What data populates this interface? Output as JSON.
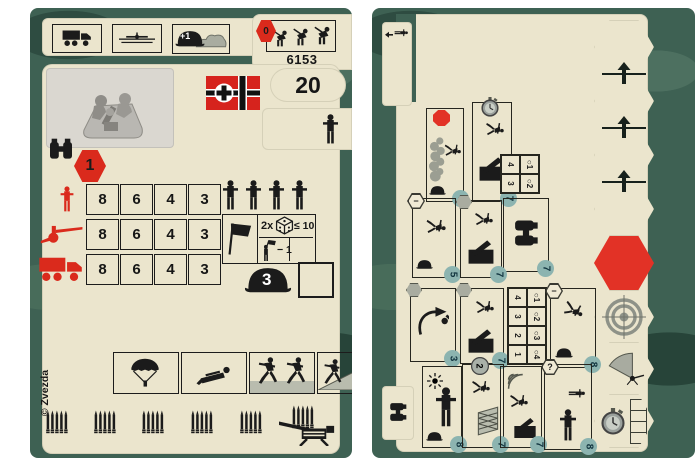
{
  "left_card": {
    "product_code": "6153",
    "points": "20",
    "cover_bonus": "+1",
    "entrench_badge": "0",
    "recon_badge": "1",
    "top_icons": [
      "truck-transport",
      "air-transport",
      "cover-bonus-terrain",
      "entrench-order"
    ],
    "flag": "german-war-flag",
    "photo": "mortar-crew-miniature",
    "stats": {
      "rows": [
        {
          "target": "infantry",
          "values": [
            "8",
            "6",
            "4",
            "3"
          ]
        },
        {
          "target": "artillery",
          "values": [
            "8",
            "6",
            "4",
            "3"
          ]
        },
        {
          "target": "vehicle",
          "values": [
            "8",
            "6",
            "4",
            "3"
          ]
        }
      ]
    },
    "squad_figures": 4,
    "morale": {
      "multiplier": "2x",
      "threshold": "≤ 10",
      "penalty": "− 1"
    },
    "helmet_value": "3",
    "ability_icons": [
      "parachute-drop",
      "crawl",
      "assault-charge",
      "vault-obstacle"
    ],
    "ammo_clips": 6,
    "copyright": "© Zvezda"
  },
  "right_card": {
    "small_table": {
      "headers": [
        "○1",
        "○2"
      ],
      "values": [
        "4",
        "3"
      ]
    },
    "range_table": {
      "headers": [
        "○1",
        "○2",
        "○3",
        "○4"
      ],
      "values": [
        "4",
        "3",
        "2",
        "1"
      ]
    },
    "panels": [
      {
        "name": "smoke-screen",
        "badge": "stop-octagon",
        "cost": "3"
      },
      {
        "name": "mortar-fire",
        "badge": "stopwatch",
        "cost": "7"
      },
      {
        "name": "spotting",
        "badge": "",
        "cost": "7"
      },
      {
        "name": "run",
        "badge": "minus-hex",
        "cost": "5"
      },
      {
        "name": "set-up-mortar",
        "badge": "gray-hex",
        "cost": "7"
      },
      {
        "name": "grenade-throw",
        "badge": "gray-hex",
        "cost": "3"
      },
      {
        "name": "take-cover",
        "badge": "gray-hex",
        "cost": "7"
      },
      {
        "name": "bail-out",
        "badge": "minus-hex",
        "cost": "8"
      },
      {
        "name": "signal-flare",
        "badge": "",
        "cost": "8"
      },
      {
        "name": "climb-obstacle",
        "badge": "stopwatch-2",
        "cost": "7"
      },
      {
        "name": "radio-contact",
        "badge": "",
        "cost": "7"
      },
      {
        "name": "march",
        "badge": "question-hex",
        "cost": "8"
      }
    ],
    "badges": {
      "minus": "−",
      "question": "?",
      "stopwatch": "2"
    },
    "hex_track": [
      "empty",
      "move-up",
      "move-up",
      "move-up",
      "red-stop",
      "target",
      "fire-arc",
      "stopwatch-track"
    ]
  }
}
